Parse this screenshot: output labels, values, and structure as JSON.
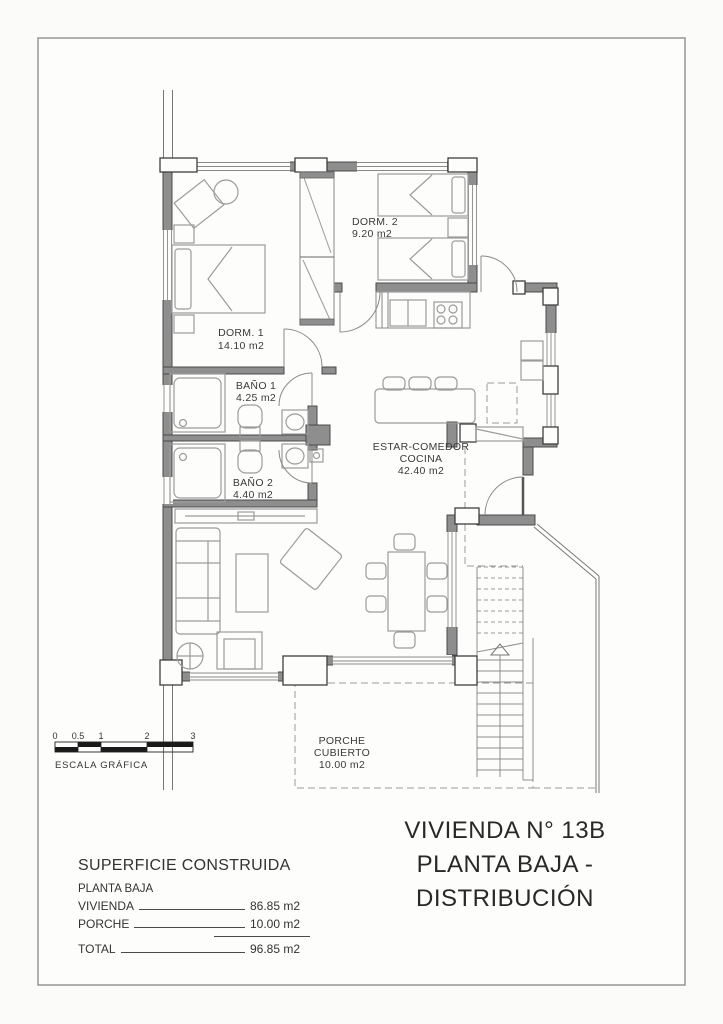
{
  "title_block": {
    "line1": "VIVIENDA N° 13B",
    "line2": "PLANTA BAJA - DISTRIBUCIÓN"
  },
  "plan": {
    "rooms": [
      {
        "name": "DORM. 1",
        "area": "14.10 m2"
      },
      {
        "name": "DORM. 2",
        "area": "9.20 m2"
      },
      {
        "name": "BAÑO 1",
        "area": "4.25 m2"
      },
      {
        "name": "BAÑO 2",
        "area": "4.40 m2"
      },
      {
        "name": "ESTAR-COMEDOR",
        "name2": "COCINA",
        "area": "42.40 m2"
      },
      {
        "name": "PORCHE",
        "name2": "CUBIERTO",
        "area": "10.00 m2"
      }
    ]
  },
  "scale_bar": {
    "ticks": [
      "0",
      "0.5",
      "1",
      "2",
      "3"
    ],
    "caption": "ESCALA GRÁFICA"
  },
  "area_table": {
    "header": "SUPERFICIE CONSTRUIDA",
    "subheader": "PLANTA BAJA",
    "rows": [
      {
        "label": "VIVIENDA",
        "value": "86.85 m2"
      },
      {
        "label": "PORCHE",
        "value": "10.00 m2"
      }
    ],
    "total": {
      "label": "TOTAL",
      "value": "96.85 m2"
    }
  },
  "colors": {
    "wall_fill": "#8e8e8e",
    "line": "#4a4a4a",
    "furniture": "#9b9b9b",
    "text": "#3a3a3a",
    "page_border": "#8f8f8f"
  }
}
